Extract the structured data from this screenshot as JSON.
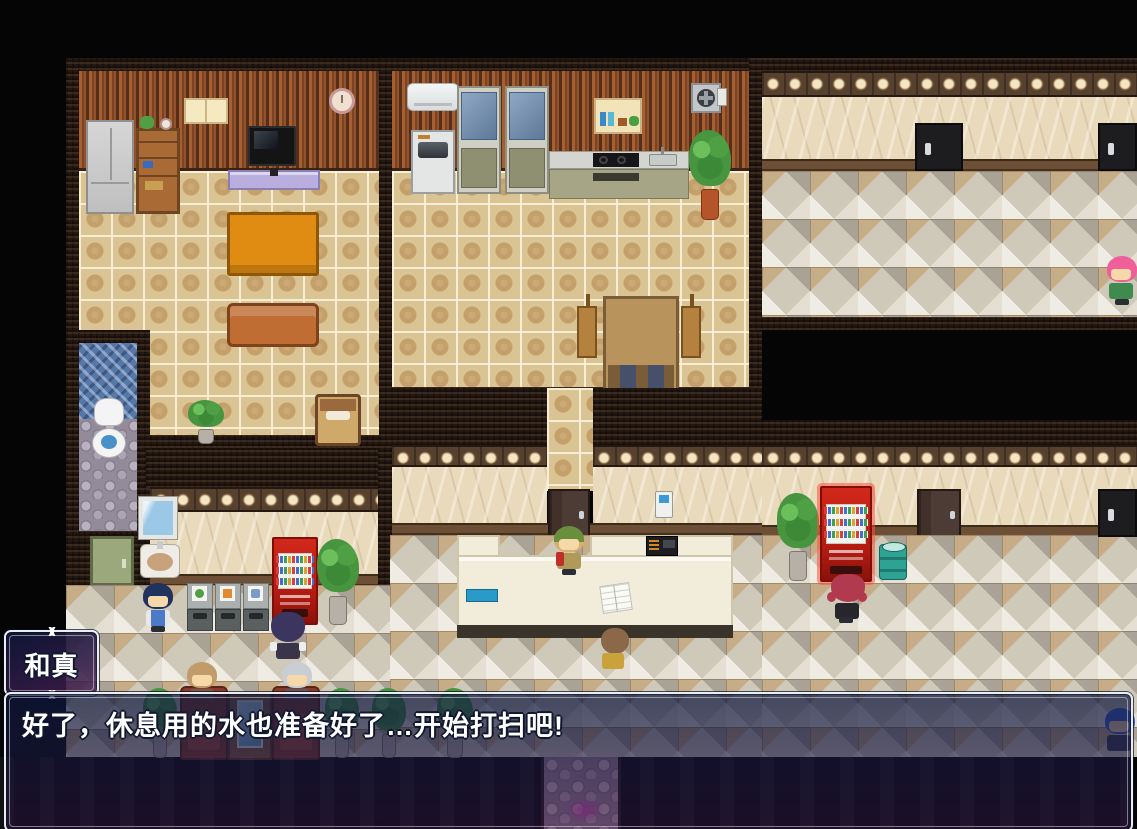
{
  "app": {
    "type": "top-down RPG game screen (RPG-Maker style interior map)"
  },
  "dialogue": {
    "speaker_name": "和真",
    "message_text": "好了，休息用的水也准备好了…开始打扫吧!"
  },
  "ui_colors": {
    "window_border": "#e9edf5",
    "window_background_top": "rgba(14,24,62,0.72)",
    "window_background_bottom": "rgba(44,22,66,0.55)",
    "message_text_color": "#ffffff",
    "text_outline_color": "#11182e"
  },
  "map": {
    "rooms": [
      "living-room",
      "kitchen",
      "upper-hallway",
      "toilet-room",
      "lobby",
      "waiting-area",
      "exit-path"
    ],
    "npcs": [
      {
        "id": "npc-receptionist",
        "hat": "#6a8f3c",
        "hair": "#d8b06a",
        "outfit": "#b09a5a",
        "accent": "#c03028"
      },
      {
        "id": "npc-customer-brown",
        "hair": "#8a6848",
        "outfit": "#caa23c"
      },
      {
        "id": "npc-kid-blue",
        "hair": "#22325e",
        "outfit": "#4a7ac8"
      },
      {
        "id": "npc-purple-hair",
        "hair": "#3c3560",
        "outfit": "#3a3448"
      },
      {
        "id": "npc-gray-hair-seated",
        "hair": "#c9ced4",
        "outfit": "#5a5a66"
      },
      {
        "id": "npc-brown-hair-seated",
        "hair": "#c29b6b",
        "outfit": "#7a5a48"
      },
      {
        "id": "npc-red-hair",
        "hair": "#b23a4e",
        "outfit": "#26262c"
      },
      {
        "id": "npc-pink-hair",
        "hair": "#ef5f9a",
        "outfit": "#3f8a4f"
      },
      {
        "id": "npc-blue-hair",
        "hair": "#3a64d8",
        "outfit": "#3a3f52"
      }
    ],
    "objects": [
      "wardrobe",
      "bookshelf",
      "tv",
      "tv-stand",
      "window",
      "wall-clock",
      "low-table",
      "sofa",
      "bed",
      "potted-plant",
      "air-conditioner",
      "washing-machine",
      "glass-cabinet",
      "wall-shelf",
      "ventilation-fan",
      "kitchen-counter",
      "dining-table",
      "chair",
      "hallway-door",
      "toilet",
      "mirror",
      "sink",
      "green-door",
      "recycle-bins",
      "vending-machine",
      "reception-counter",
      "cash-register",
      "ledger-book",
      "call-panel",
      "barrel",
      "armchair",
      "side-table",
      "cobblestone-exit"
    ],
    "accent_colors": {
      "vending_machine_red": "#d2281a",
      "vending_machine_highlight": "#ff5040",
      "barrel_teal": "#2ea395",
      "floor_tan": "#dbc493",
      "hall_floor_gray": "#cfc9ba",
      "wall_beige": "#e9dabc",
      "wallpaper_stripe": "#a85f30",
      "frame_dark": "#241812",
      "green_door": "#9aa87c"
    }
  }
}
